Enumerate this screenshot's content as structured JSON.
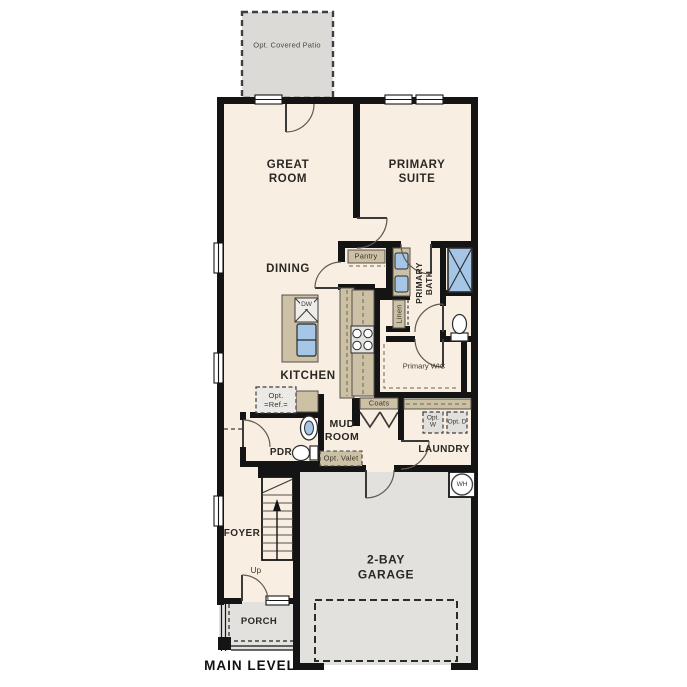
{
  "colors": {
    "floor": "#f8efe2",
    "garage_floor": "#e2e1de",
    "patio_fill": "#dbdad7",
    "wall": "#141414",
    "cabinet_tan": "#cdc1a5",
    "fixture_blue": "#a5c6e6",
    "text": "#2b2824"
  },
  "labels": {
    "patio": "Opt. Covered Patio",
    "great_room": "GREAT ROOM",
    "primary_suite": "PRIMARY SUITE",
    "dining": "DINING",
    "kitchen": "KITCHEN",
    "pantry": "Pantry",
    "primary_bath": "PRIMARY BATH",
    "linen": "Linen",
    "primary_wic": "Primary WIC",
    "coats": "Coats",
    "mud_room": "MUD ROOM",
    "laundry": "LAUNDRY",
    "opt_w": "Opt. W",
    "opt_d": "Opt. D",
    "opt_valet": "Opt. Valet",
    "opt_ref": "Opt. =Ref.=",
    "pdr": "PDR",
    "foyer": "FOYER",
    "up": "Up",
    "dw": "DW",
    "wh": "WH",
    "garage": "2-BAY GARAGE",
    "porch": "PORCH",
    "main_level": "MAIN LEVEL"
  }
}
